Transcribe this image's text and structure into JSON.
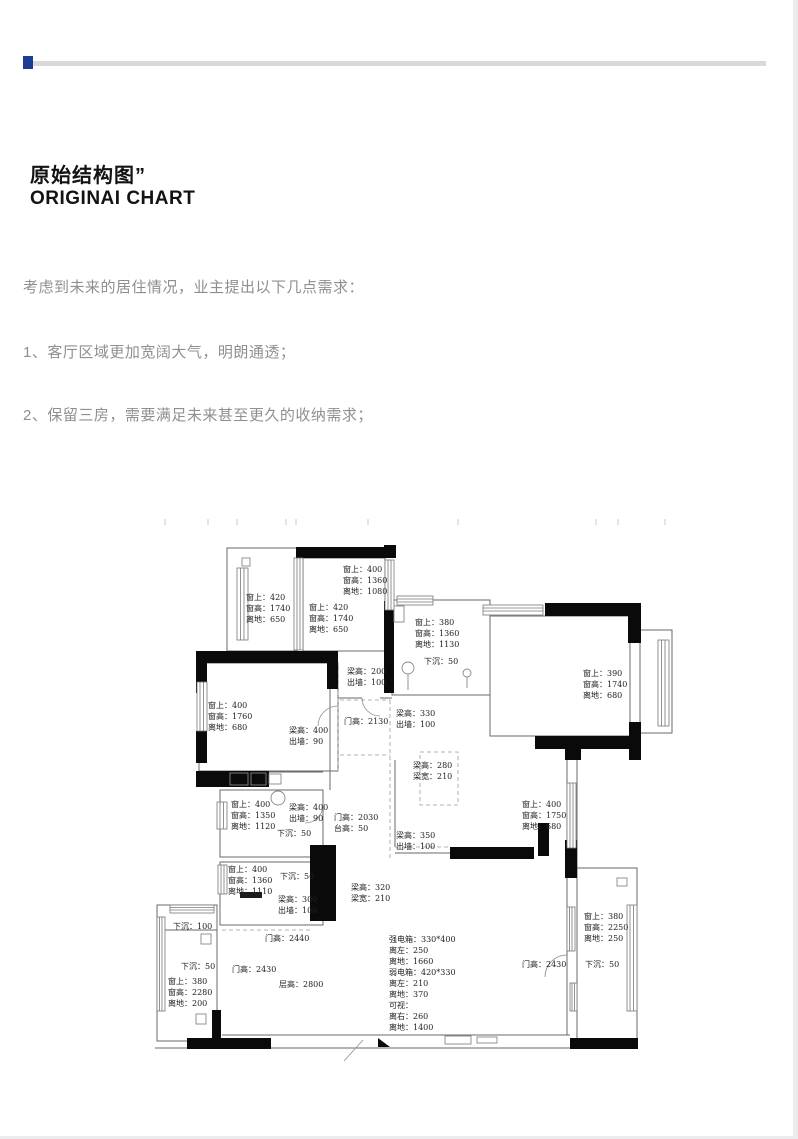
{
  "page": {
    "accent_color": "#1c3b92",
    "divider_color": "#d9d9d9",
    "wall_color": "#0a0a0a"
  },
  "header": {
    "title_cn": "原始结构图”",
    "title_en": "ORIGINAI CHART"
  },
  "intro": {
    "lead": "考虑到未来的居住情况，业主提出以下几点需求：",
    "requirements": [
      "1、客厅区域更加宽阔大气，明朗通透；",
      "2、保留三房，需要满足未来甚至更久的收纳需求；"
    ]
  },
  "floorplan": {
    "annotations": [
      {
        "x": 106,
        "y": 82,
        "lines": [
          "窗上：420",
          "窗高：1740",
          "离地：650"
        ]
      },
      {
        "x": 203,
        "y": 54,
        "lines": [
          "窗上：400",
          "窗高：1360",
          "离地：1080"
        ]
      },
      {
        "x": 169,
        "y": 92,
        "lines": [
          "窗上：420",
          "窗高：1740",
          "离地：650"
        ]
      },
      {
        "x": 207,
        "y": 156,
        "lines": [
          "梁高：200",
          "出墙：100"
        ]
      },
      {
        "x": 275,
        "y": 107,
        "lines": [
          "窗上：380",
          "窗高：1360",
          "离地：1130"
        ]
      },
      {
        "x": 284,
        "y": 146,
        "lines": [
          "下沉：50"
        ]
      },
      {
        "x": 443,
        "y": 158,
        "lines": [
          "窗上：390",
          "窗高：1740",
          "离地：680"
        ]
      },
      {
        "x": 68,
        "y": 190,
        "lines": [
          "窗上：400",
          "窗高：1760",
          "离地：680"
        ]
      },
      {
        "x": 149,
        "y": 215,
        "lines": [
          "梁高：400",
          "出墙：90"
        ]
      },
      {
        "x": 204,
        "y": 206,
        "lines": [
          "门高：2130"
        ]
      },
      {
        "x": 256,
        "y": 198,
        "lines": [
          "梁高：330",
          "出墙：100"
        ]
      },
      {
        "x": 273,
        "y": 250,
        "lines": [
          "梁高：280",
          "梁宽：210"
        ]
      },
      {
        "x": 91,
        "y": 289,
        "lines": [
          "窗上：400",
          "窗高：1350",
          "离地：1120"
        ]
      },
      {
        "x": 149,
        "y": 292,
        "lines": [
          "梁高：400",
          "出墙：90"
        ]
      },
      {
        "x": 137,
        "y": 318,
        "lines": [
          "下沉：50"
        ]
      },
      {
        "x": 194,
        "y": 302,
        "lines": [
          "门高：2030",
          "台高：50"
        ]
      },
      {
        "x": 256,
        "y": 320,
        "lines": [
          "梁高：350",
          "出墙：100"
        ]
      },
      {
        "x": 382,
        "y": 289,
        "lines": [
          "窗上：400",
          "窗高：1750",
          "离地：680"
        ]
      },
      {
        "x": 88,
        "y": 354,
        "lines": [
          "窗上：400",
          "窗高：1360",
          "离地：1110"
        ]
      },
      {
        "x": 140,
        "y": 361,
        "lines": [
          "下沉：50"
        ]
      },
      {
        "x": 138,
        "y": 384,
        "lines": [
          "梁高：300",
          "出墙：100"
        ]
      },
      {
        "x": 211,
        "y": 372,
        "lines": [
          "梁高：320",
          "梁宽：210"
        ]
      },
      {
        "x": 33,
        "y": 411,
        "lines": [
          "下沉：100"
        ]
      },
      {
        "x": 125,
        "y": 423,
        "lines": [
          "门高：2440"
        ]
      },
      {
        "x": 41,
        "y": 451,
        "lines": [
          "下沉：50"
        ]
      },
      {
        "x": 28,
        "y": 466,
        "lines": [
          "窗上：380",
          "窗高：2280",
          "离地：200"
        ]
      },
      {
        "x": 92,
        "y": 454,
        "lines": [
          "门高：2430"
        ]
      },
      {
        "x": 139,
        "y": 469,
        "lines": [
          "层高：2800"
        ]
      },
      {
        "x": 249,
        "y": 424,
        "lines": [
          "强电箱：330*400",
          "离左：250",
          "离地：1660",
          "弱电箱：420*330",
          "离左：210",
          "离地：370",
          "可视：",
          "离右：260",
          "离地：1400"
        ]
      },
      {
        "x": 382,
        "y": 449,
        "lines": [
          "门高：2430"
        ]
      },
      {
        "x": 444,
        "y": 401,
        "lines": [
          "窗上：380",
          "窗高：2250",
          "离地：250"
        ]
      },
      {
        "x": 445,
        "y": 449,
        "lines": [
          "下沉：50"
        ]
      }
    ]
  }
}
